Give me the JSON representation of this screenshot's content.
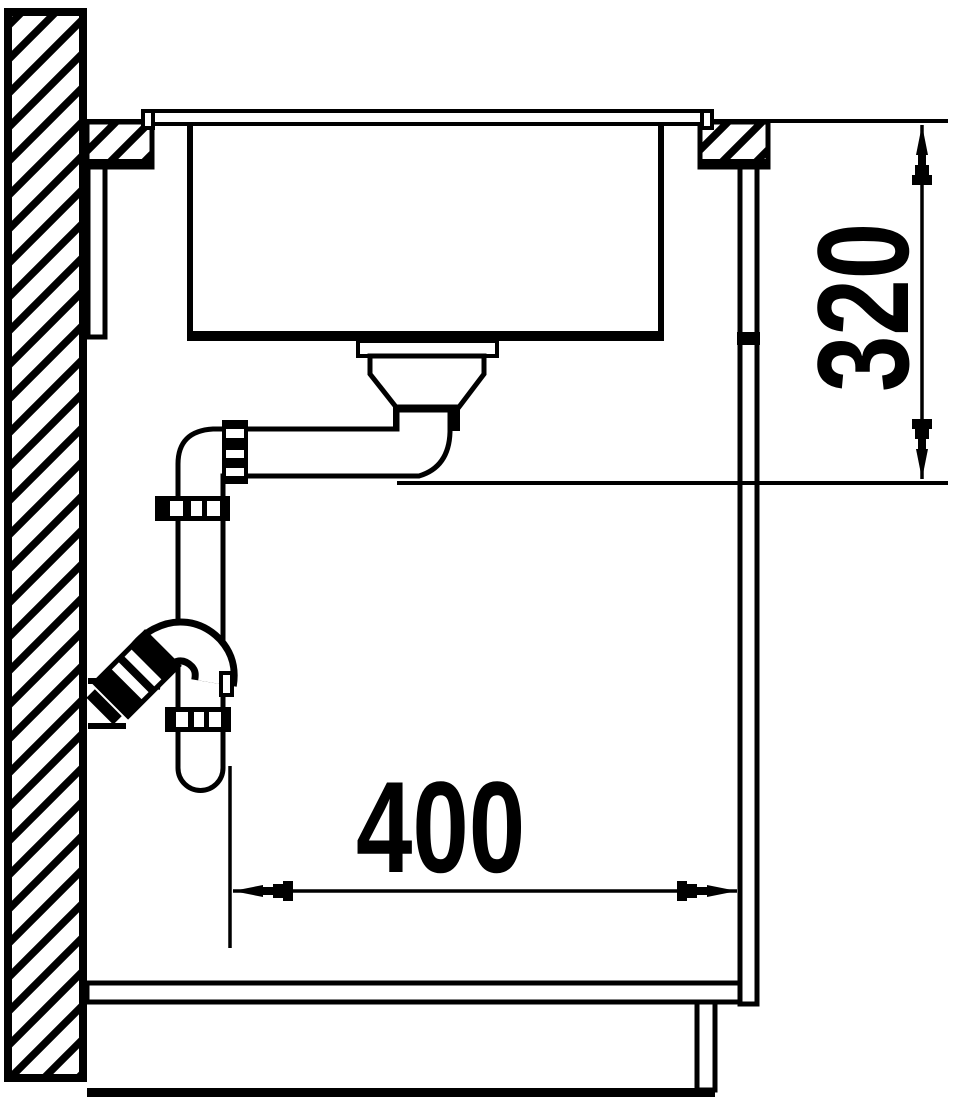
{
  "page": {
    "paper_color": "#ffffff",
    "ink_color": "#000000"
  },
  "diagram": {
    "title": "Sink installation side cross-section",
    "type": "technical-drawing",
    "dimensions": {
      "vertical": {
        "label": "320",
        "orientation": "vertical",
        "from": "worktop top surface",
        "to": "underside of drain outlet elbow"
      },
      "horizontal": {
        "label": "400",
        "orientation": "horizontal",
        "from": "trap standpipe",
        "to": "cabinet front panel"
      }
    },
    "parts": {
      "wall": "masonry wall (section hatching)",
      "worktop": "worktop (section hatching)",
      "sink_flange": "sink rim flange",
      "sink_bowl": "sink bowl",
      "drain": "strainer drain assembly",
      "drain_locknut": "drain locknut",
      "outlet_pipe": "horizontal outlet pipe",
      "pipe_coupling": "union coupling nut",
      "standpipe": "vertical trap standpipe",
      "trap_bend": "tubular trap bend",
      "wall_outlet": "wall drain outlet stub",
      "cabinet": "base cabinet carcass",
      "plinth": "cabinet plinth",
      "floor": "floor line"
    }
  }
}
